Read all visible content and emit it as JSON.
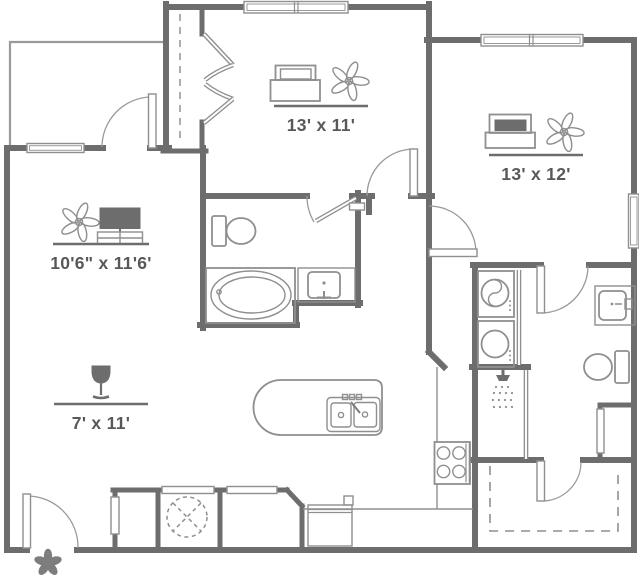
{
  "canvas": {
    "width": 639,
    "height": 582,
    "background": "#ffffff"
  },
  "colors": {
    "wall": "#6d6d6d",
    "fixture_line": "#8f8f8f",
    "light_line": "#9a9a9a",
    "label_text": "#58585a",
    "dark_fill": "#6d6d6d"
  },
  "rooms": [
    {
      "name": "bedroom-1",
      "dimensions": "13' x 11'",
      "icons": [
        "bed-icon",
        "ceiling-fan-icon"
      ]
    },
    {
      "name": "bedroom-2",
      "dimensions": "13' x 12'",
      "icons": [
        "bed-icon",
        "ceiling-fan-icon"
      ]
    },
    {
      "name": "living-room",
      "dimensions": "10'6\" x 11'6'",
      "icons": [
        "ceiling-fan-icon",
        "tv-console-icon"
      ]
    },
    {
      "name": "dining-area",
      "dimensions": "7' x 11'",
      "icons": [
        "wine-glass-icon"
      ]
    }
  ],
  "fixtures": [
    "bathtub",
    "toilet",
    "vanity-sink",
    "shower-head",
    "stacked-washer-dryer",
    "kitchen-island-with-double-sink",
    "range-stove",
    "dishwasher",
    "water-heater",
    "bifold-closet-doors",
    "entry-flower-marker",
    "windows",
    "interior-doors",
    "dashed-patio-outline"
  ]
}
